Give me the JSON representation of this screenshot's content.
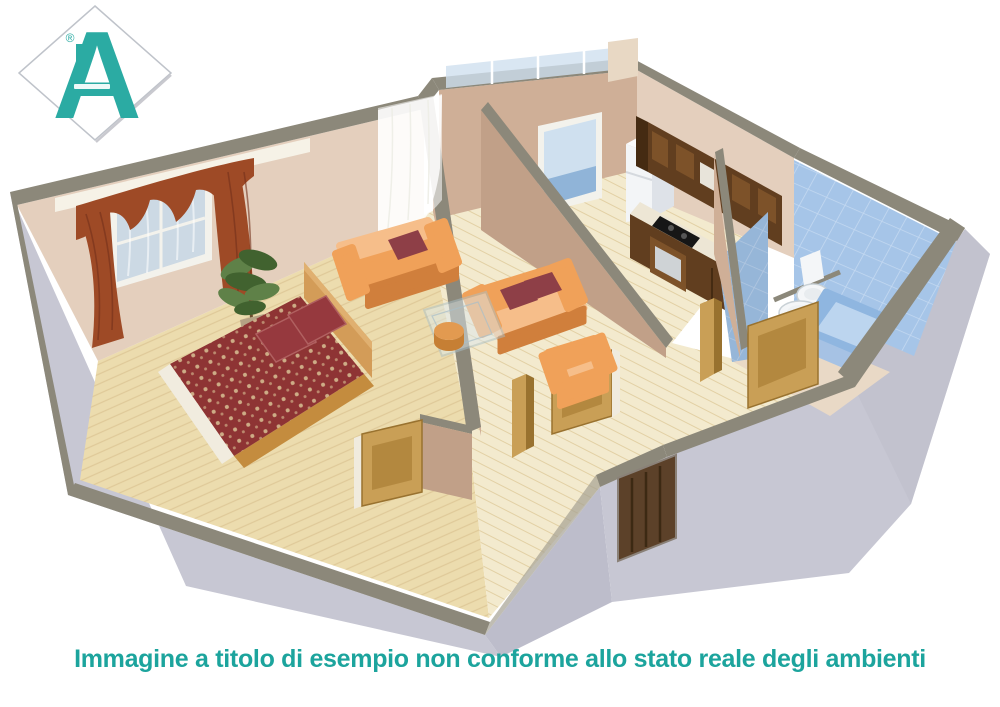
{
  "caption": {
    "text": "Immagine a titolo di esempio non conforme allo stato reale degli ambienti",
    "color": "#1CA49D"
  },
  "logo": {
    "letter": "A",
    "registered_mark": "®",
    "color": "#2BABA3",
    "diamond_border": "#BFC3CA"
  },
  "scene": {
    "type": "3d-floorplan-render",
    "rooms": [
      "bedroom",
      "living-room",
      "kitchen",
      "bathroom",
      "hallway",
      "balcony"
    ]
  },
  "palette": {
    "teal": "#1CA49D",
    "tealLogo": "#2BABA3",
    "band": "#8C887A",
    "bandL": "#A5A193",
    "grey": "#C7C7D3",
    "grey2": "#BDBDCB",
    "greyL": "#D9D9E3",
    "tan": "#CFAF97",
    "tanL": "#E4CFBD",
    "tanD": "#C1A088",
    "lintel": "#F6F2E7",
    "wood": "#ECDCAE",
    "woodLine": "#DCC493",
    "woodL": "#F3EACE",
    "blanket": "#8E3434",
    "blanketFleck": "#D9C194",
    "pillow": "#96393E",
    "bedWood": "#C48C3E",
    "headboard": "#D39C58",
    "sheet": "#F1ECDF",
    "sofa": "#F0A159",
    "sofaL": "#F6BE8A",
    "sofaSh": "#D07F3C",
    "sofaPillow": "#8E3F47",
    "glassTable": "#DCE8EC",
    "glassTableLine": "#A9BFC7",
    "stool": "#E29A50",
    "stoolD": "#C67F34",
    "curtain": "#9E4A26",
    "curtainD": "#73301A",
    "plant": "#5F8148",
    "plantD": "#41622F",
    "pot": "#B5A284",
    "trunk": "#6B4F2F",
    "cabinet": "#613E1F",
    "cabinetD": "#452B12",
    "cabinetL": "#7D5229",
    "counter": "#EDE6D5",
    "cooktop": "#161616",
    "fridge": "#F3F5F7",
    "fridgeSide": "#DEE2E8",
    "fridgeTop": "#FAFBFC",
    "tile": "#A6C5E8",
    "tileLine": "#C4D9F1",
    "tub": "#8FB6E0",
    "tubIn": "#BCD5EF",
    "tubSide": "#A6C2E4",
    "fixture": "#F4F6F8",
    "fixtureSh": "#C9D1D6",
    "door": "#C99F56",
    "doorPanel": "#B3883F",
    "doorEdge": "#99722F",
    "doorJamb": "#F0EBDE",
    "entrance": "#5C4129",
    "entranceLine": "#3C2913",
    "glass": "#CFE0EF",
    "glassDeep": "#7FA9D2",
    "winFrame": "#F3F2EC",
    "white": "#FFFFFF"
  }
}
